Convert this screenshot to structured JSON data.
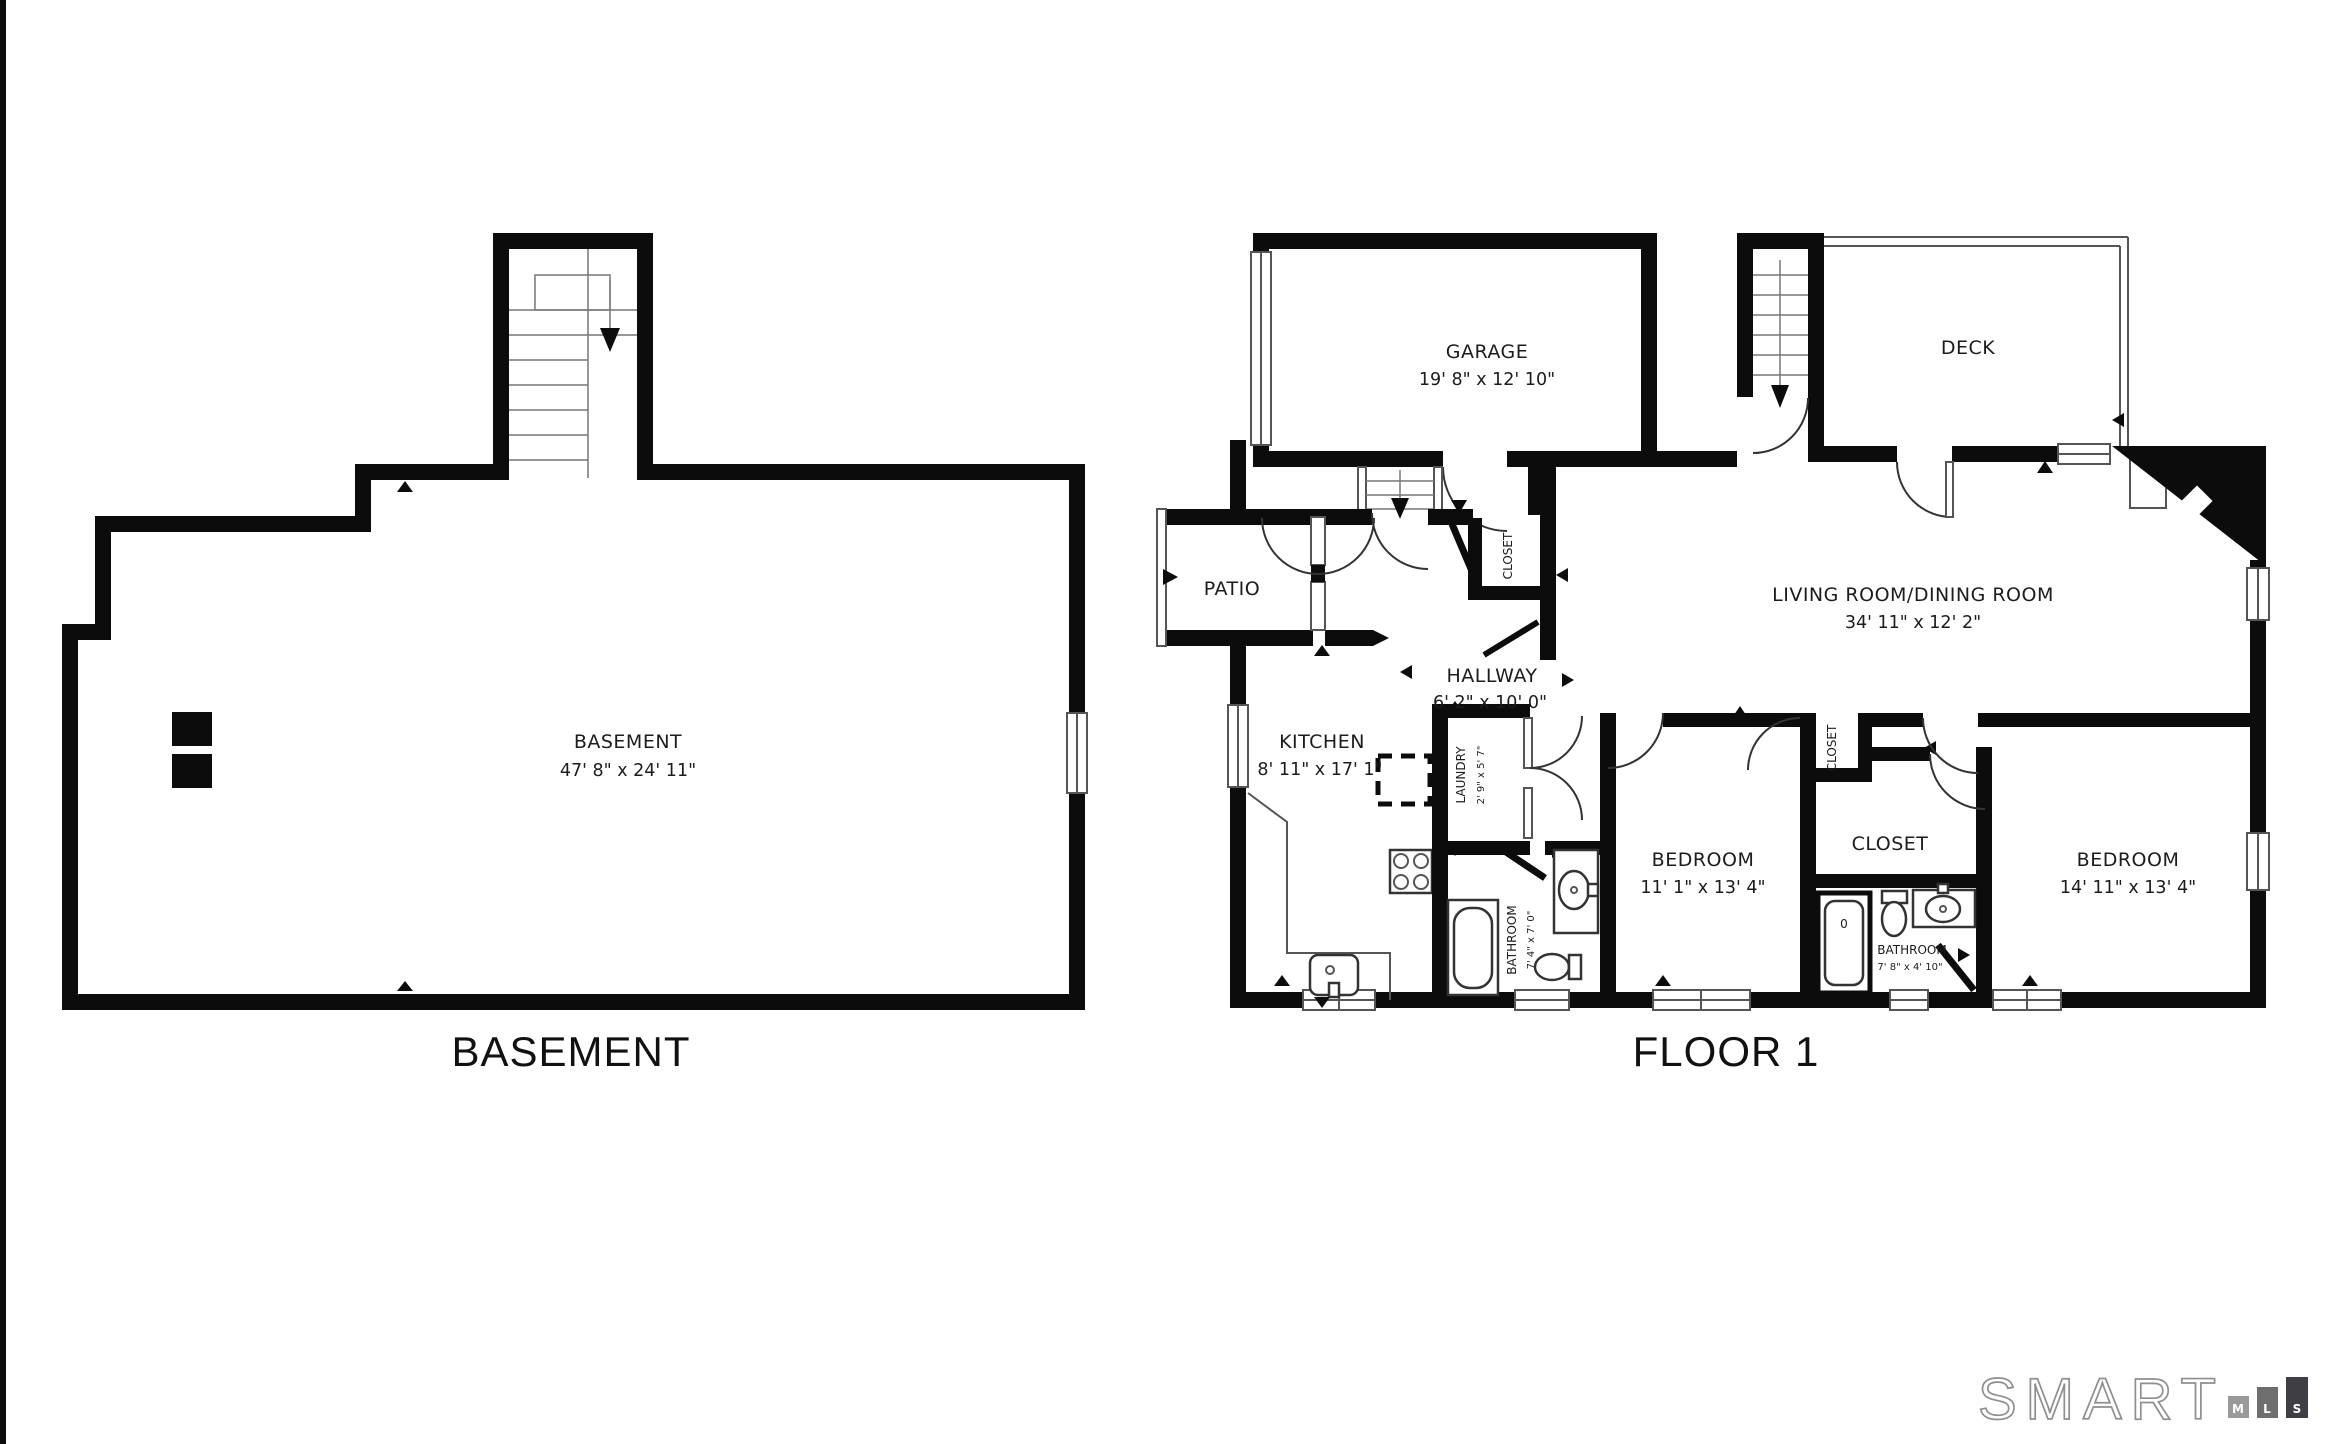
{
  "page": {
    "background": "#ffffff",
    "wall_color": "#0c0c0c",
    "text_color": "#1c1c1c"
  },
  "basement": {
    "title": "BASEMENT",
    "room": {
      "name": "BASEMENT",
      "dims": "47' 8\" x 24' 11\""
    }
  },
  "floor1": {
    "title": "FLOOR 1",
    "rooms": {
      "garage": {
        "name": "GARAGE",
        "dims": "19' 8\" x 12' 10\""
      },
      "deck": {
        "name": "DECK"
      },
      "living": {
        "name": "LIVING ROOM/DINING ROOM",
        "dims": "34' 11\" x 12' 2\""
      },
      "patio": {
        "name": "PATIO"
      },
      "hallway": {
        "name": "HALLWAY",
        "dims": "6' 2\" x 10' 0\""
      },
      "kitchen": {
        "name": "KITCHEN",
        "dims": "8' 11\" x 17' 1\""
      },
      "laundry": {
        "name": "LAUNDRY",
        "dims": "2' 9\" x 5' 7\""
      },
      "bathroom_main": {
        "name": "BATHROOM",
        "dims": "7' 4\" x 7' 0\""
      },
      "closet_hall": {
        "name": "CLOSET"
      },
      "bedroom_left": {
        "name": "BEDROOM",
        "dims": "11' 1\" x 13' 4\""
      },
      "closet_bedroom": {
        "name": "CLOSET"
      },
      "closet_center": {
        "name": "CLOSET"
      },
      "bathroom_small": {
        "name": "BATHROOM",
        "dims": "7' 8\" x 4' 10\""
      },
      "bedroom_right": {
        "name": "BEDROOM",
        "dims": "14' 11\" x 13' 4\""
      },
      "shower_mark": "0"
    }
  },
  "logo": {
    "brand": "SMART",
    "outline_color": "#8f8f8f",
    "blocks": [
      {
        "letter": "M",
        "color": "#9a9a9a"
      },
      {
        "letter": "L",
        "color": "#6e6e6e"
      },
      {
        "letter": "S",
        "color": "#3e3e44"
      }
    ]
  }
}
